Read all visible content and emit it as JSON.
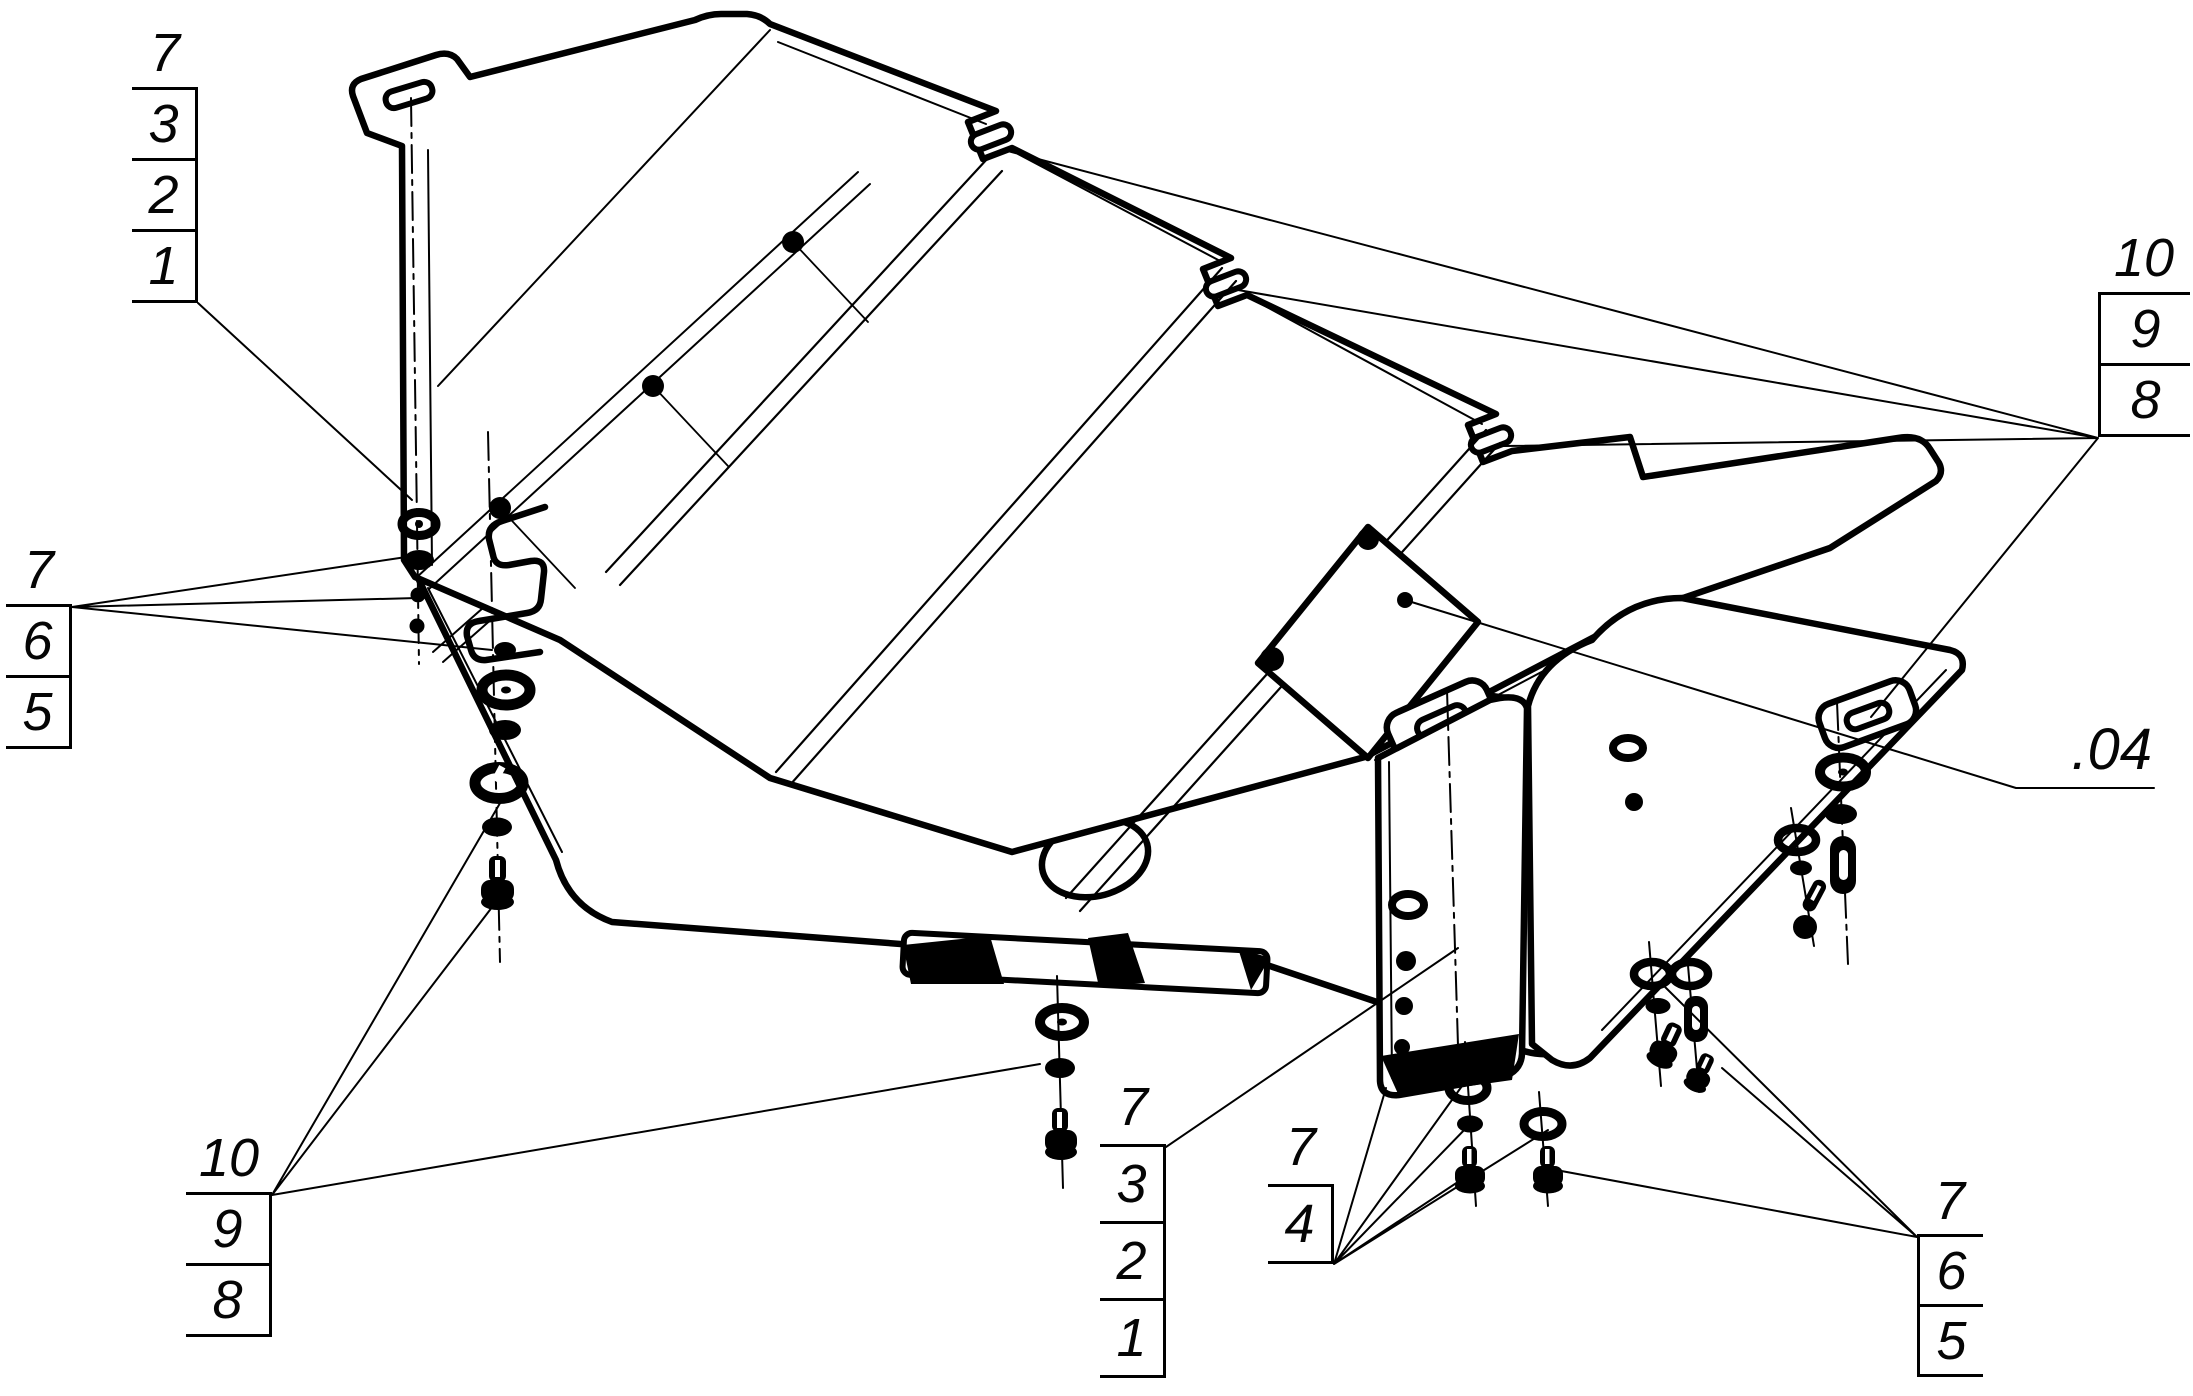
{
  "drawing": {
    "reference_label": ".04",
    "callouts": {
      "top_left": {
        "items": [
          "7",
          "3",
          "2",
          "1"
        ]
      },
      "mid_left": {
        "items": [
          "7",
          "6",
          "5"
        ]
      },
      "bottom_left": {
        "items": [
          "10",
          "9",
          "8"
        ]
      },
      "bottom_center": {
        "items": [
          "7",
          "3",
          "2",
          "1"
        ]
      },
      "bottom_center_right": {
        "items": [
          "7",
          "4"
        ]
      },
      "bottom_right": {
        "items": [
          "7",
          "6",
          "5"
        ]
      },
      "right": {
        "items": [
          "10",
          "9",
          "8"
        ]
      }
    },
    "colors": {
      "line": "#000000",
      "background": "#ffffff"
    }
  }
}
